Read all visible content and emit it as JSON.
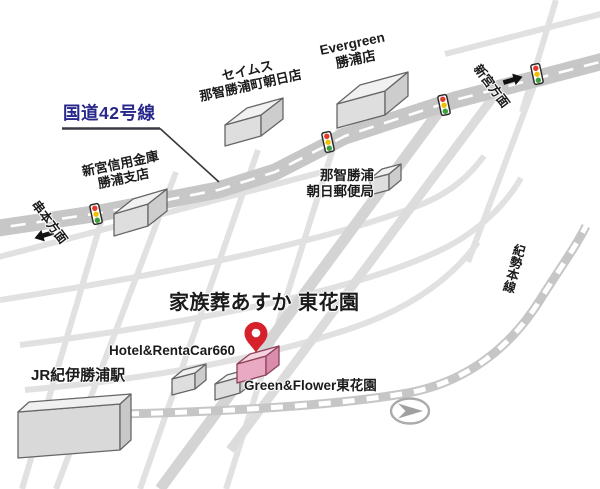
{
  "map": {
    "destination": {
      "name": "家族葬あすか 東花園",
      "marker_icon": "map-pin-icon"
    },
    "route42": {
      "label": "国道42号線"
    },
    "landmarks": {
      "seimusu": {
        "line1": "セイムス",
        "line2": "那智勝浦町朝日店"
      },
      "evergreen": {
        "line1": "Evergreen",
        "line2": "勝浦店"
      },
      "shingu_bank": {
        "line1": "新宮信用金庫",
        "line2": "勝浦支店"
      },
      "post_office": {
        "line1": "那智勝浦",
        "line2": "朝日郵便局"
      },
      "station": {
        "name": "JR紀伊勝浦駅"
      },
      "hotel": {
        "name": "Hotel&RentaCar660"
      },
      "green_flower": {
        "name": "Green&Flower東花園"
      }
    },
    "directions": {
      "kushimoto": "串本方面",
      "shingu": "新宮方面"
    },
    "railway": {
      "name": "紀勢本線"
    },
    "colors": {
      "route_label_blue": "#28288c",
      "pin_red": "#d6202b",
      "destination_pink": "#eaa9c3",
      "main_road_gray": "#c7c7c7",
      "street_gray": "#e1e1e1",
      "signal_red": "#e23a2e",
      "signal_yellow": "#f3c000",
      "signal_green": "#3ba03b"
    }
  }
}
